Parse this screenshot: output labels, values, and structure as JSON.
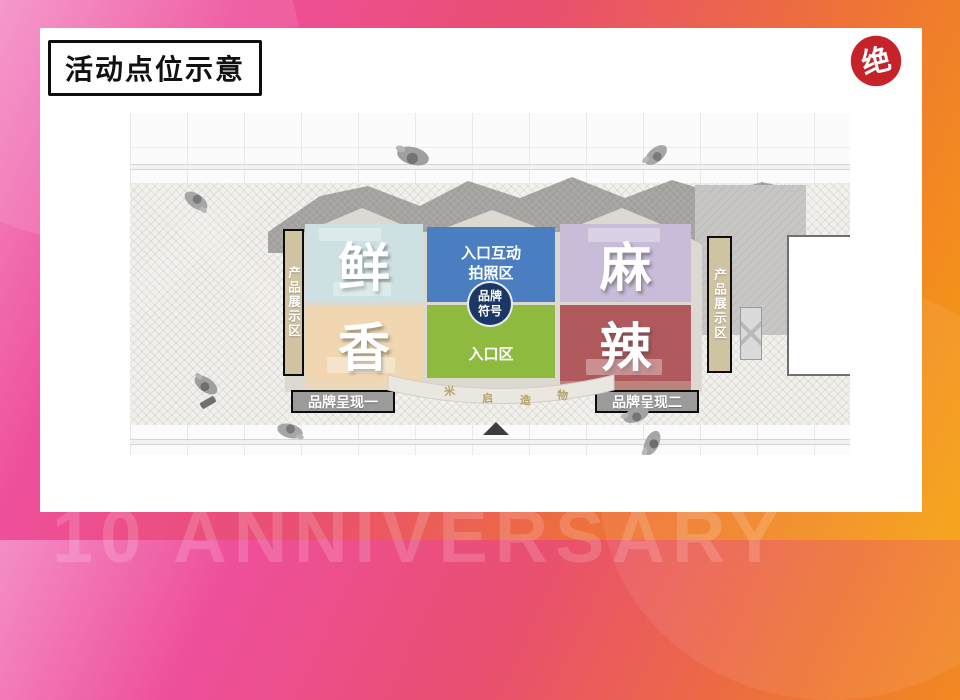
{
  "slide": {
    "title": "活动点位示意",
    "watermark": "10 ANNIVERSARY",
    "logo_char": "绝"
  },
  "plan": {
    "zones": [
      {
        "label": "鲜",
        "color": "#cde0e2"
      },
      {
        "label": "香",
        "color": "#f1d7b1"
      },
      {
        "label": "麻",
        "color": "#c8bcd8"
      },
      {
        "label": "辣",
        "color": "#b05a5d"
      }
    ],
    "photo_area": {
      "line1": "入口互动",
      "line2": "拍照区"
    },
    "brand_symbol": {
      "line1": "品牌",
      "line2": "符号"
    },
    "entrance_label": "入口区",
    "display_bar_label": "产品展示区",
    "brand_labels": [
      "品牌呈现一",
      "品牌呈现二"
    ],
    "storefront_sign": [
      "米",
      "启",
      "造",
      "物"
    ]
  },
  "colors": {
    "photo_area_blue": "#4b7ec0",
    "entrance_green": "#8fba40",
    "brand_circle_navy": "#1b3765",
    "display_bar_tan": "#cfc3a2",
    "brand_label_gray": "#9b9b9b",
    "spicy_red": "#b05a5d",
    "logo_red": "#c5222a",
    "frame_pink": "#ee4f9b",
    "frame_orange": "#f6a00d"
  }
}
